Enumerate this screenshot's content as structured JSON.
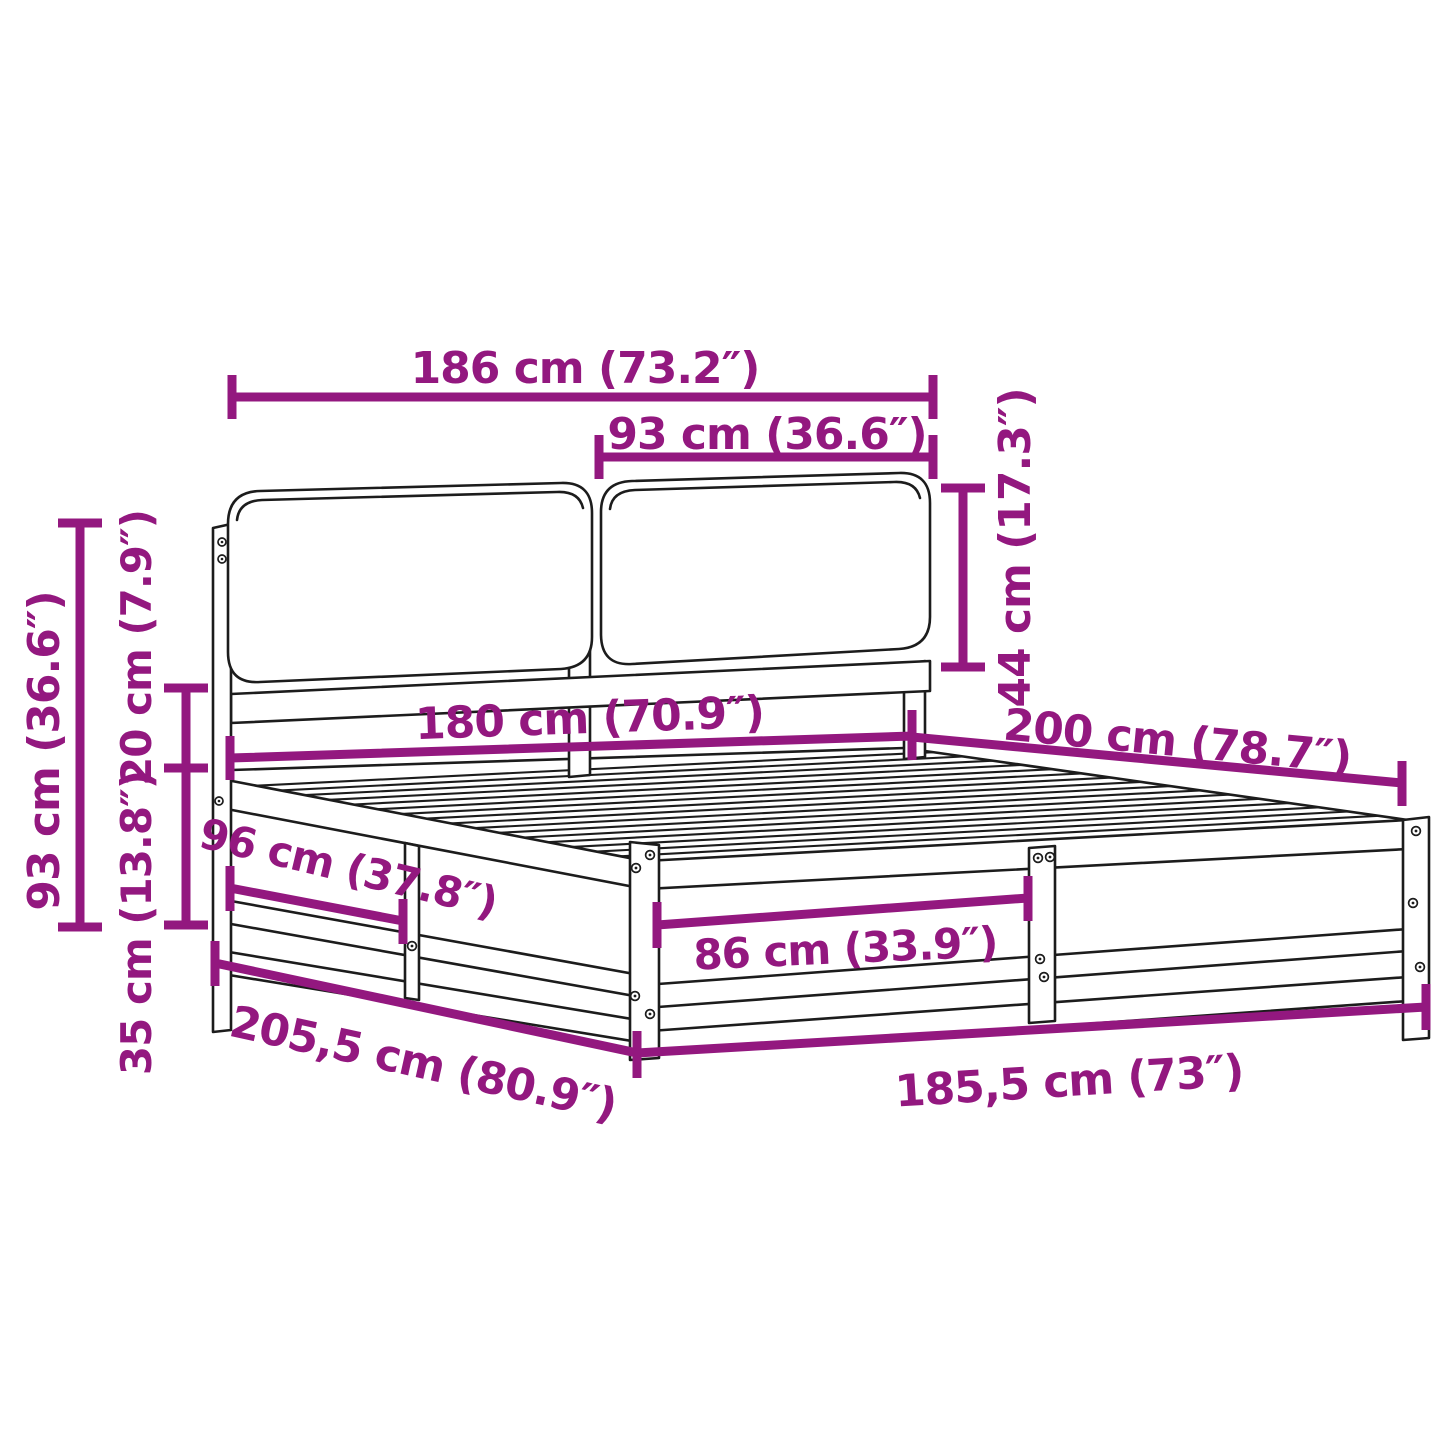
{
  "diagram": {
    "type": "product-dimension-line-drawing",
    "subject": "bed frame with storage base and two headboard cushions",
    "accent_color": "#93187f",
    "line_color": "#1c1c1c",
    "background_color": "#ffffff",
    "units": [
      "cm",
      "inches"
    ]
  },
  "dimensions": [
    {
      "id": "headboard-total-width",
      "label": "186 cm (73.2″)"
    },
    {
      "id": "cushion-width",
      "label": "93 cm (36.6″)"
    },
    {
      "id": "cushion-height",
      "label": "44 cm (17.3″)"
    },
    {
      "id": "headboard-height",
      "label": "93 cm (36.6″)"
    },
    {
      "id": "headboard-gap-height",
      "label": "20 cm (7.9″)"
    },
    {
      "id": "base-height",
      "label": "35 cm (13.8″)"
    },
    {
      "id": "bed-inner-width",
      "label": "180 cm (70.9″)"
    },
    {
      "id": "bed-inner-length",
      "label": "200 cm (78.7″)"
    },
    {
      "id": "side-section-length",
      "label": "96 cm (37.8″)"
    },
    {
      "id": "front-section-width",
      "label": "86 cm (33.9″)"
    },
    {
      "id": "total-length",
      "label": "205,5 cm (80.9″)"
    },
    {
      "id": "total-width",
      "label": "185,5 cm (73″)"
    }
  ]
}
